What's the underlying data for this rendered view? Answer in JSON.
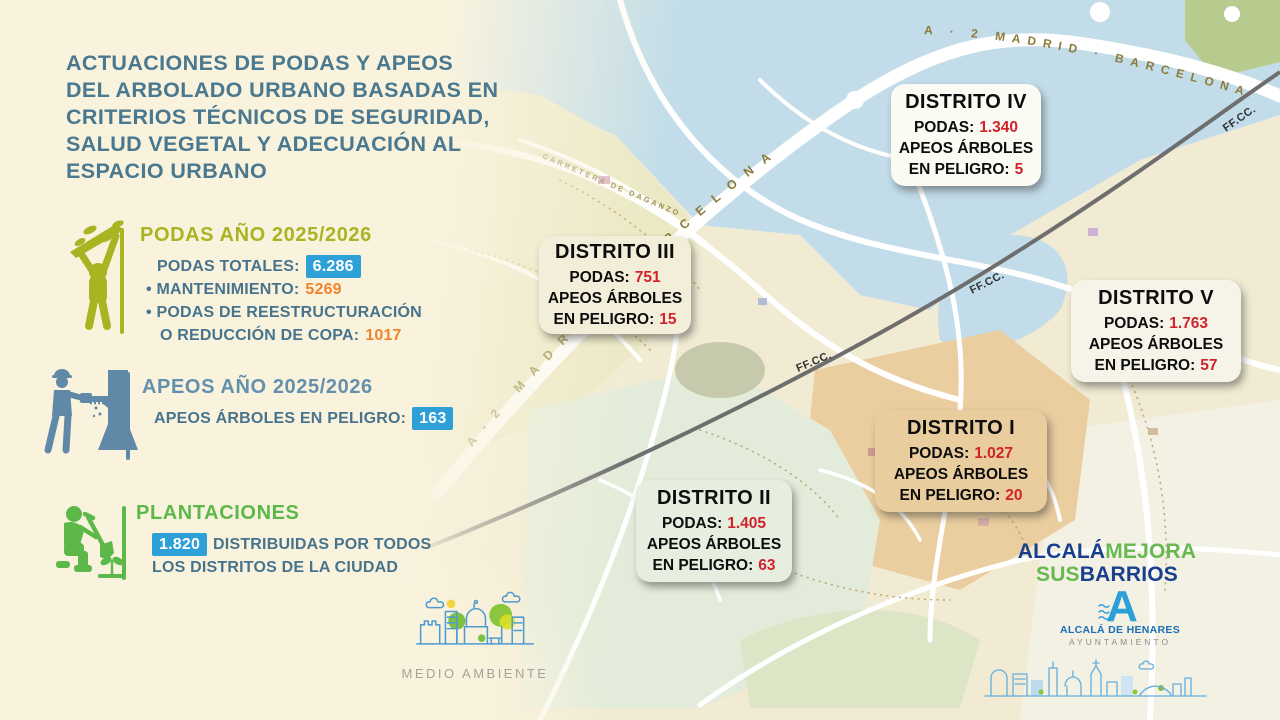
{
  "title": {
    "lines": [
      "ACTUACIONES DE PODAS Y APEOS",
      "DEL ARBOLADO URBANO BASADAS EN",
      "CRITERIOS TÉCNICOS DE SEGURIDAD,",
      "SALUD VEGETAL Y ADECUACIÓN AL",
      "ESPACIO URBANO"
    ]
  },
  "podas": {
    "heading": "PODAS AÑO 2025/2026",
    "total_label": "PODAS TOTALES:",
    "total_value": "6.286",
    "bullet1_label": "• MANTENIMIENTO:",
    "bullet1_value": "5269",
    "bullet2_line1": "• PODAS DE REESTRUCTURACIÓN",
    "bullet2_line2": "O REDUCCIÓN DE COPA:",
    "bullet2_value": "1017"
  },
  "apeos": {
    "heading": "APEOS AÑO 2025/2026",
    "label": "APEOS ÁRBOLES EN PELIGRO:",
    "value": "163"
  },
  "plantaciones": {
    "heading": "PLANTACIONES",
    "value": "1.820",
    "text_line1": "DISTRIBUIDAS POR TODOS",
    "text_line2": "LOS DISTRITOS DE LA CIUDAD"
  },
  "districts": [
    {
      "name": "DISTRITO IV",
      "podas_label": "PODAS:",
      "podas_value": "1.340",
      "apeos_line1": "APEOS ÁRBOLES",
      "apeos_label": "EN PELIGRO:",
      "apeos_value": "5"
    },
    {
      "name": "DISTRITO III",
      "podas_label": "PODAS:",
      "podas_value": "751",
      "apeos_line1": "APEOS ÁRBOLES",
      "apeos_label": "EN PELIGRO:",
      "apeos_value": "15"
    },
    {
      "name": "DISTRITO V",
      "podas_label": "PODAS:",
      "podas_value": "1.763",
      "apeos_line1": "APEOS ÁRBOLES",
      "apeos_label": "EN PELIGRO:",
      "apeos_value": "57"
    },
    {
      "name": "DISTRITO I",
      "podas_label": "PODAS:",
      "podas_value": "1.027",
      "apeos_line1": "APEOS ÁRBOLES",
      "apeos_label": "EN PELIGRO:",
      "apeos_value": "20"
    },
    {
      "name": "DISTRITO II",
      "podas_label": "PODAS:",
      "podas_value": "1.405",
      "apeos_line1": "APEOS ÁRBOLES",
      "apeos_label": "EN PELIGRO:",
      "apeos_value": "63"
    }
  ],
  "map": {
    "road_label_a2": "A-2 MADRID · BARCELONA",
    "road_label_a2_top": "A · 2 MADRID · BARCELONA",
    "rail_label": "FF.CC.",
    "street_label": "CARRETERA DE DAGANZO"
  },
  "logos": {
    "medio_ambiente": "MEDIO AMBIENTE",
    "mejora_line1_a": "ALCALÁ",
    "mejora_line1_b": "MEJORA",
    "mejora_line2_a": "SUS",
    "mejora_line2_b": "BARRIOS",
    "ayto_name": "ALCALÁ DE HENARES",
    "ayto_sub": "AYUNTAMIENTO"
  },
  "colors": {
    "background": "#f9f3de",
    "text_teal": "#47748c",
    "accent_olive": "#a9b422",
    "accent_steel": "#6089a7",
    "accent_green": "#5cb848",
    "accent_orange": "#f0832c",
    "badge_blue": "#2da0d8",
    "value_red": "#d0232b"
  }
}
